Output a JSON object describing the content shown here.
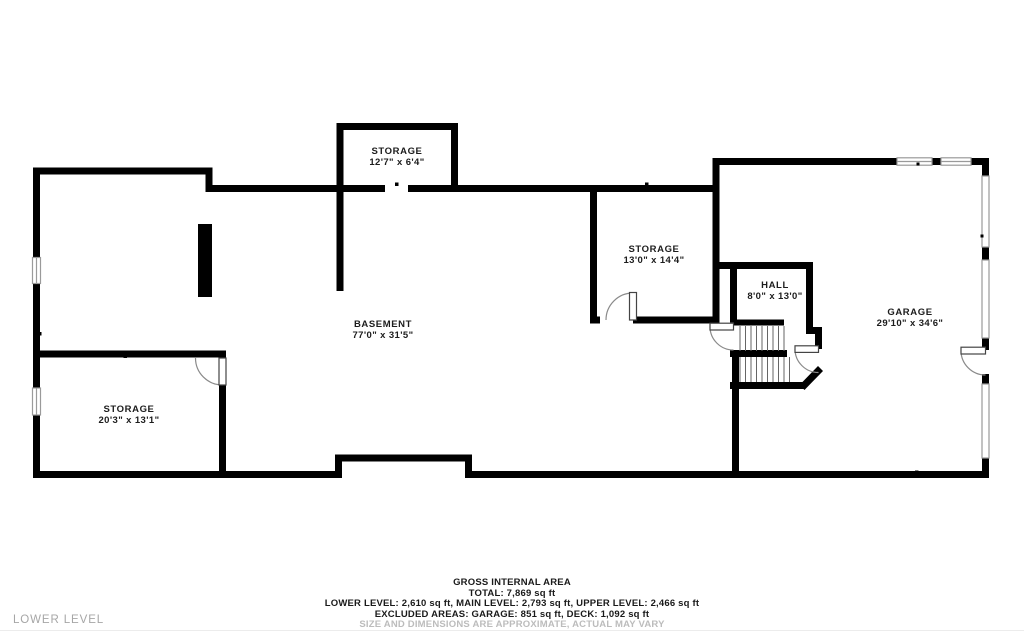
{
  "floor_label": "LOWER LEVEL",
  "rooms": {
    "storage_top": {
      "name": "STORAGE",
      "dims": "12'7\" x 6'4\""
    },
    "storage_mid": {
      "name": "STORAGE",
      "dims": "13'0\" x 14'4\""
    },
    "hall": {
      "name": "HALL",
      "dims": "8'0\" x 13'0\""
    },
    "garage": {
      "name": "GARAGE",
      "dims": "29'10\" x 34'6\""
    },
    "basement": {
      "name": "BASEMENT",
      "dims": "77'0\" x 31'5\""
    },
    "storage_left": {
      "name": "STORAGE",
      "dims": "20'3\" x 13'1\""
    }
  },
  "summary": {
    "title": "GROSS INTERNAL AREA",
    "total": "TOTAL: 7,869 sq ft",
    "levels": "LOWER LEVEL: 2,610 sq ft, MAIN LEVEL: 2,793 sq ft, UPPER LEVEL: 2,466 sq ft",
    "excluded": "EXCLUDED AREAS: GARAGE: 851 sq ft, DECK: 1,092 sq ft",
    "disclaimer": "SIZE AND DIMENSIONS ARE APPROXIMATE, ACTUAL MAY VARY"
  },
  "colors": {
    "wall": "#000000",
    "label_text": "#1c1c1c",
    "muted_text": "#bcbcbc",
    "floor_label_text": "#a6a6a6",
    "thin_wall": "#9a9a9a"
  }
}
